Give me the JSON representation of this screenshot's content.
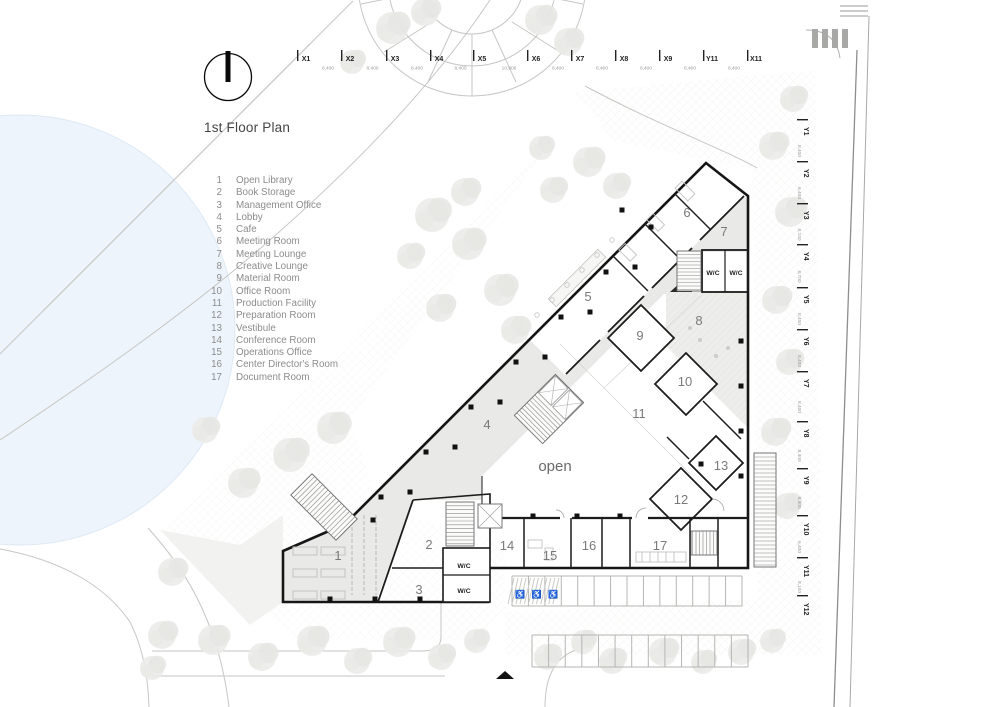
{
  "title": "1st Floor Plan",
  "legend": {
    "items": [
      {
        "num": "1",
        "name": "Open Library"
      },
      {
        "num": "2",
        "name": "Book Storage"
      },
      {
        "num": "3",
        "name": "Management Office"
      },
      {
        "num": "4",
        "name": "Lobby"
      },
      {
        "num": "5",
        "name": "Cafe"
      },
      {
        "num": "6",
        "name": "Meeting Room"
      },
      {
        "num": "7",
        "name": "Meeting Lounge"
      },
      {
        "num": "8",
        "name": "Creative Lounge"
      },
      {
        "num": "9",
        "name": "Material Room"
      },
      {
        "num": "10",
        "name": "Office Room"
      },
      {
        "num": "11",
        "name": "Production Facility"
      },
      {
        "num": "12",
        "name": "Preparation Room"
      },
      {
        "num": "13",
        "name": "Vestibule"
      },
      {
        "num": "14",
        "name": "Conference Room"
      },
      {
        "num": "15",
        "name": "Operations Office"
      },
      {
        "num": "16",
        "name": "Center Director's Room"
      },
      {
        "num": "17",
        "name": "Document Room"
      }
    ]
  },
  "axes": {
    "top": [
      {
        "label": "X1",
        "x": 303,
        "dim": "8,400"
      },
      {
        "label": "X2",
        "x": 347,
        "dim": "8,400"
      },
      {
        "label": "X3",
        "x": 392,
        "dim": "8,400"
      },
      {
        "label": "X4",
        "x": 436,
        "dim": "8,400"
      },
      {
        "label": "X5",
        "x": 479,
        "dim": "10,906"
      },
      {
        "label": "X6",
        "x": 533,
        "dim": "8,400"
      },
      {
        "label": "X7",
        "x": 577,
        "dim": "8,400"
      },
      {
        "label": "X8",
        "x": 621,
        "dim": "8,400"
      },
      {
        "label": "X9",
        "x": 665,
        "dim": "8,400"
      },
      {
        "label": "Y11",
        "x": 709,
        "dim": "8,400"
      },
      {
        "label": "X11",
        "x": 753,
        "dim": ""
      }
    ],
    "right": [
      {
        "label": "Y1",
        "y": 128,
        "dim": "8,400"
      },
      {
        "label": "Y2",
        "y": 170,
        "dim": "6,400"
      },
      {
        "label": "Y3",
        "y": 212,
        "dim": "8,100"
      },
      {
        "label": "Y4",
        "y": 253,
        "dim": "8,700"
      },
      {
        "label": "Y5",
        "y": 296,
        "dim": "8,400"
      },
      {
        "label": "Y6",
        "y": 338,
        "dim": "8,400"
      },
      {
        "label": "Y7",
        "y": 380,
        "dim": "8,400"
      },
      {
        "label": "Y8",
        "y": 430,
        "dim": "8,400"
      },
      {
        "label": "Y9",
        "y": 477,
        "dim": "8,400"
      },
      {
        "label": "Y10",
        "y": 524,
        "dim": "6,400"
      },
      {
        "label": "Y11",
        "y": 566,
        "dim": "8,100"
      },
      {
        "label": "Y12",
        "y": 604,
        "dim": ""
      }
    ]
  },
  "plan": {
    "open_label": "open",
    "open_pos": {
      "x": 555,
      "y": 471
    },
    "wc_label": "W/C",
    "wc_positions": [
      {
        "x": 713,
        "y": 275
      },
      {
        "x": 736,
        "y": 275
      },
      {
        "x": 464,
        "y": 568
      },
      {
        "x": 464,
        "y": 593
      }
    ],
    "room_labels": [
      {
        "num": "1",
        "x": 338,
        "y": 560
      },
      {
        "num": "2",
        "x": 429,
        "y": 549
      },
      {
        "num": "3",
        "x": 419,
        "y": 594
      },
      {
        "num": "4",
        "x": 487,
        "y": 429
      },
      {
        "num": "5",
        "x": 588,
        "y": 301
      },
      {
        "num": "6",
        "x": 687,
        "y": 217
      },
      {
        "num": "7",
        "x": 724,
        "y": 236
      },
      {
        "num": "8",
        "x": 699,
        "y": 325
      },
      {
        "num": "9",
        "x": 640,
        "y": 340
      },
      {
        "num": "10",
        "x": 685,
        "y": 386
      },
      {
        "num": "11",
        "x": 639,
        "y": 418
      },
      {
        "num": "12",
        "x": 681,
        "y": 504
      },
      {
        "num": "13",
        "x": 721,
        "y": 470
      },
      {
        "num": "14",
        "x": 507,
        "y": 550
      },
      {
        "num": "15",
        "x": 550,
        "y": 560
      },
      {
        "num": "16",
        "x": 589,
        "y": 550
      },
      {
        "num": "17",
        "x": 660,
        "y": 550
      }
    ],
    "columns": [
      [
        651,
        227
      ],
      [
        606,
        272
      ],
      [
        561,
        317
      ],
      [
        516,
        362
      ],
      [
        471,
        407
      ],
      [
        426,
        452
      ],
      [
        381,
        497
      ],
      [
        635,
        267
      ],
      [
        590,
        312
      ],
      [
        545,
        357
      ],
      [
        500,
        402
      ],
      [
        455,
        447
      ],
      [
        410,
        492
      ],
      [
        533,
        516
      ],
      [
        577,
        516
      ],
      [
        620,
        516
      ],
      [
        741,
        341
      ],
      [
        741,
        386
      ],
      [
        741,
        431
      ],
      [
        741,
        476
      ],
      [
        330,
        599
      ],
      [
        375,
        599
      ],
      [
        420,
        599
      ],
      [
        373,
        520
      ],
      [
        701,
        464
      ],
      [
        622,
        210
      ]
    ],
    "trees": [
      [
        392,
        28,
        16
      ],
      [
        425,
        12,
        14
      ],
      [
        540,
        20,
        15
      ],
      [
        568,
        42,
        14
      ],
      [
        352,
        62,
        12
      ],
      [
        432,
        215,
        17
      ],
      [
        468,
        244,
        16
      ],
      [
        500,
        290,
        16
      ],
      [
        440,
        308,
        14
      ],
      [
        515,
        330,
        14
      ],
      [
        465,
        192,
        14
      ],
      [
        410,
        256,
        13
      ],
      [
        553,
        190,
        13
      ],
      [
        588,
        162,
        15
      ],
      [
        616,
        186,
        13
      ],
      [
        541,
        148,
        12
      ],
      [
        773,
        146,
        14
      ],
      [
        790,
        212,
        15
      ],
      [
        776,
        300,
        14
      ],
      [
        789,
        362,
        13
      ],
      [
        775,
        432,
        14
      ],
      [
        787,
        506,
        13
      ],
      [
        793,
        99,
        13
      ],
      [
        333,
        428,
        16
      ],
      [
        290,
        455,
        17
      ],
      [
        243,
        483,
        15
      ],
      [
        205,
        430,
        13
      ],
      [
        172,
        572,
        14
      ],
      [
        162,
        635,
        14
      ],
      [
        152,
        668,
        12
      ],
      [
        213,
        640,
        15
      ],
      [
        262,
        657,
        14
      ],
      [
        312,
        641,
        15
      ],
      [
        357,
        661,
        13
      ],
      [
        398,
        642,
        15
      ],
      [
        441,
        657,
        13
      ],
      [
        476,
        641,
        12
      ],
      [
        547,
        657,
        13
      ],
      [
        583,
        642,
        12
      ],
      [
        612,
        661,
        13
      ],
      [
        663,
        652,
        14
      ],
      [
        703,
        662,
        12
      ],
      [
        741,
        652,
        13
      ],
      [
        772,
        641,
        12
      ]
    ],
    "parking": {
      "wheelchair_symbol": "♿",
      "row1": {
        "x": 512,
        "y": 576,
        "w": 230,
        "h": 30,
        "count": 14,
        "accessible": 3
      },
      "row2": {
        "x": 532,
        "y": 635,
        "w": 216,
        "h": 32,
        "count": 13
      }
    }
  }
}
